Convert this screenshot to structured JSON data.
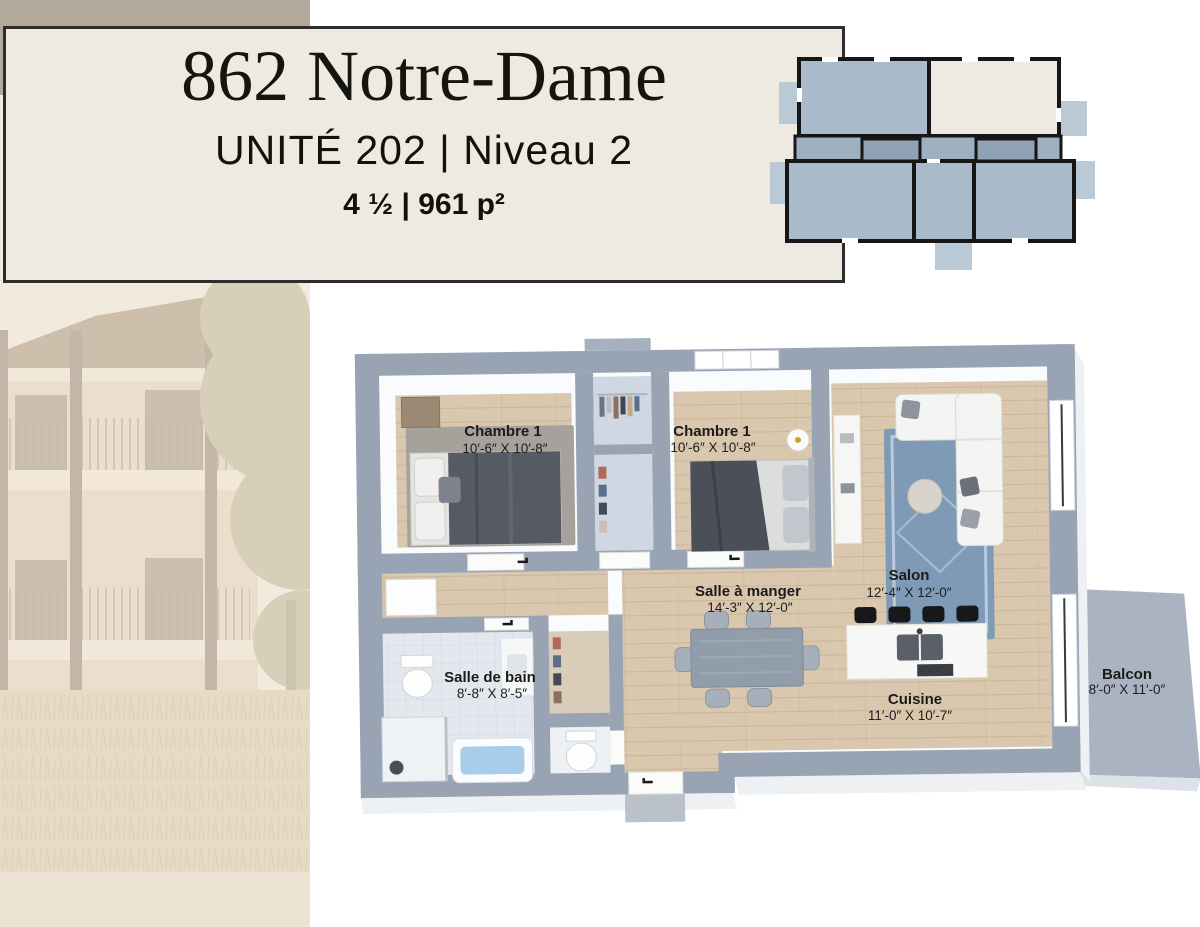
{
  "header": {
    "title": "862 Notre-Dame",
    "subtitle": "UNITÉ 202 | Niveau 2",
    "details": "4 ½ | 961 p²"
  },
  "floor_plan": {
    "rooms": {
      "chambre1": {
        "name": "Chambre 1",
        "dims": "10′-6″ X 10′-8″"
      },
      "chambre2": {
        "name": "Chambre 1",
        "dims": "10′-6″ X 10′-8″"
      },
      "salle_a_manger": {
        "name": "Salle à manger",
        "dims": "14′-3″ X 12′-0″"
      },
      "salon": {
        "name": "Salon",
        "dims": "12′-4″ X 12′-0″"
      },
      "salle_de_bain": {
        "name": "Salle de bain",
        "dims": "8′-8″ X 8′-5″"
      },
      "cuisine": {
        "name": "Cuisine",
        "dims": "11′-0″ X 10′-7″"
      },
      "balcon": {
        "name": "Balcon",
        "dims": "8′-0″ X 11′-0″"
      }
    }
  },
  "colors": {
    "panel_background": "#efeae1",
    "panel_border": "#2e2d29",
    "accent_taupe": "#b3a99b",
    "wall_gray": "#97a2b3",
    "keyplan_unit_blue": "#a9bbca",
    "keyplan_highlight_cream": "#efeae1",
    "wood_floor": "#d8c6ad",
    "rug_blue": "#7f9ab6",
    "water_blue": "#a8cdea"
  }
}
